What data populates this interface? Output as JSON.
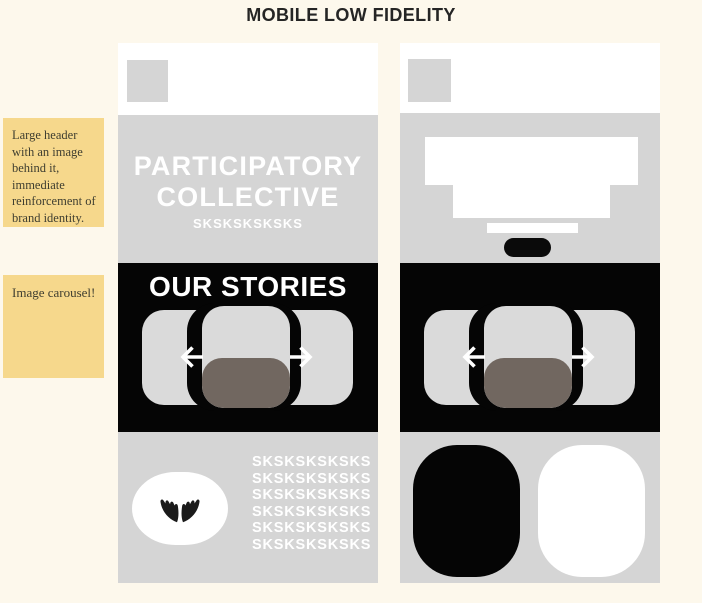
{
  "title": "MOBILE LOW FIDELITY",
  "annotations": {
    "header_note": "Large header with an image behind it, immediate reinforcement of brand identity.",
    "carousel_note": "Image carousel!"
  },
  "phone1": {
    "brand_line1": "PARTICIPATORY",
    "brand_line2": "COLLECTIVE",
    "brand_subline": "SKSKSKSKSKS",
    "stories_heading": "OUR STORIES",
    "footer_lines": [
      "SKSKSKSKSKS",
      "SKSKSKSKSKS",
      "SKSKSKSKSKS",
      "SKSKSKSKSKS",
      "SKSKSKSKSKS",
      "SKSKSKSKSKS"
    ]
  },
  "icons": {
    "phone1_logo": "logo-placeholder-icon",
    "phone2_logo": "logo-placeholder-icon",
    "hands": "open-hands-icon",
    "carousel_left": "arrow-left-icon",
    "carousel_right": "arrow-right-icon"
  },
  "colors": {
    "page_background": "#FDF8EC",
    "sticky_note": "#F6D88C",
    "panel_gray": "#D5D5D5",
    "card_gray": "#DADADA",
    "section_black": "#050505",
    "carousel_accent_taupe": "#716760",
    "heading_text": "#252525",
    "wireframe_text": "#FFFFFF"
  }
}
